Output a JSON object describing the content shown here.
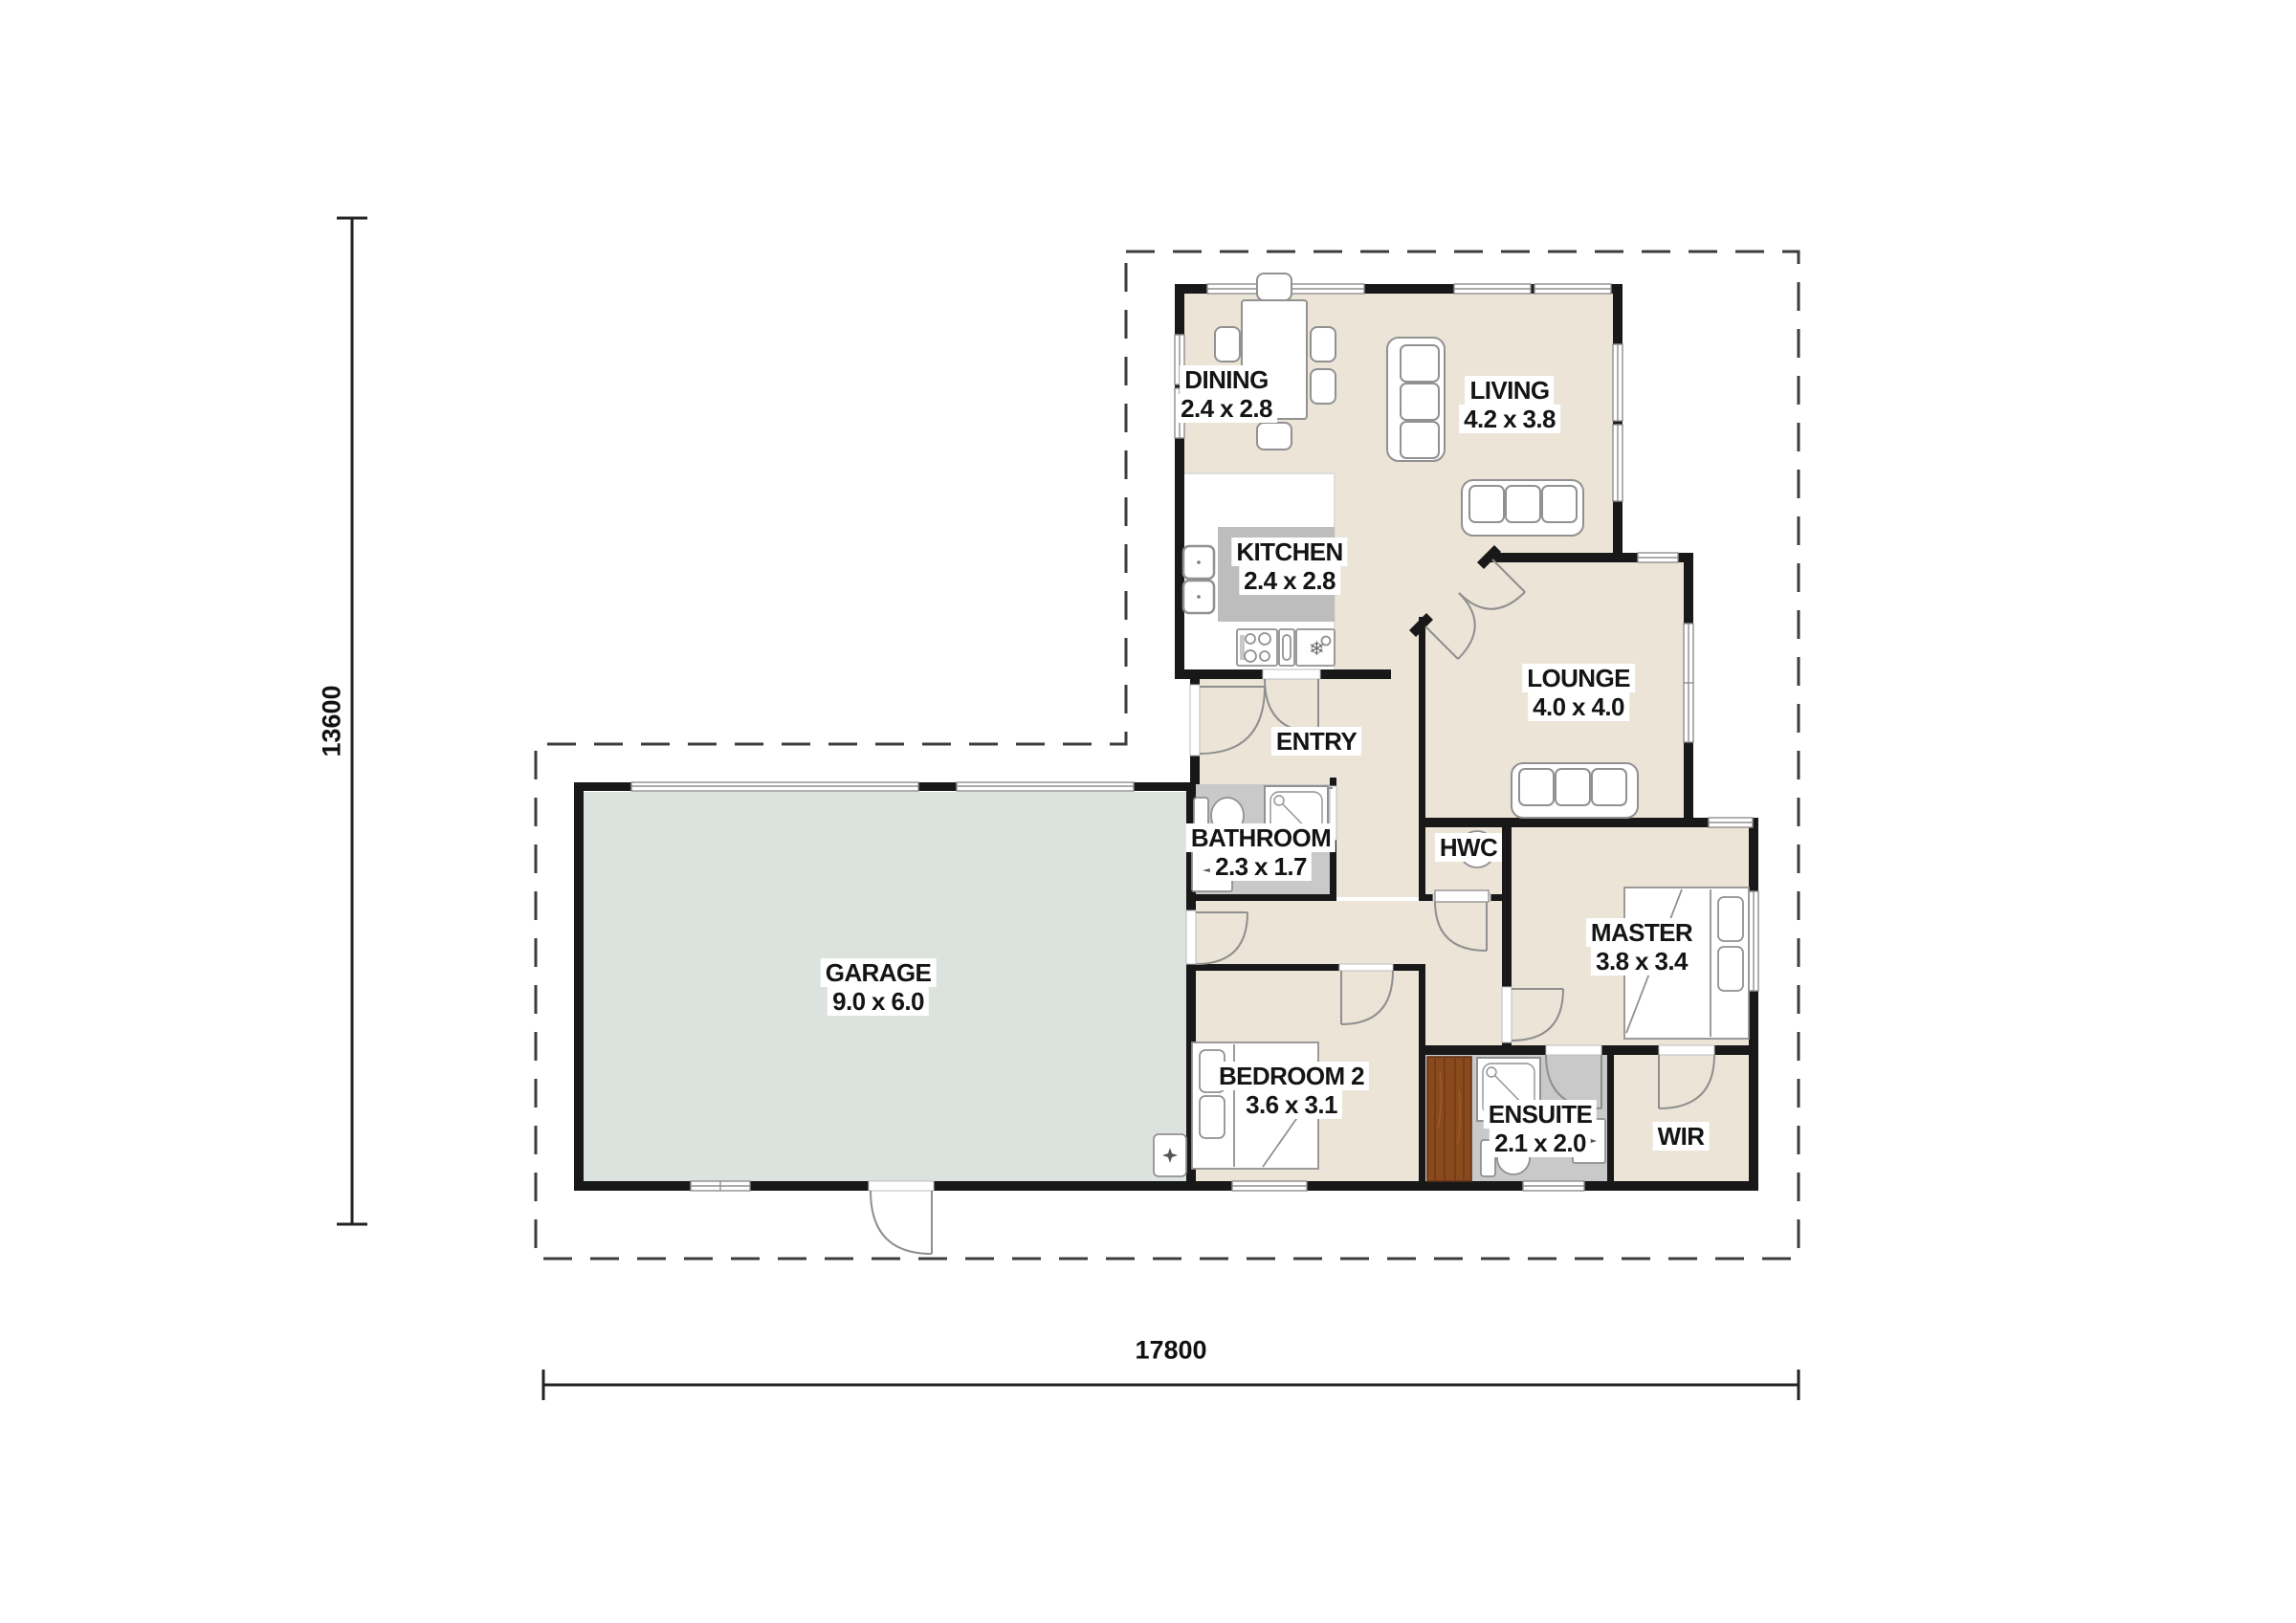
{
  "plan": {
    "type": "residential-floor-plan",
    "dimensions": {
      "width_label": "17800",
      "height_label": "13600"
    },
    "rooms": [
      {
        "id": "dining",
        "name": "DINING",
        "size": "2.4 x 2.8"
      },
      {
        "id": "living",
        "name": "LIVING",
        "size": "4.2 x 3.8"
      },
      {
        "id": "kitchen",
        "name": "KITCHEN",
        "size": "2.4 x 2.8"
      },
      {
        "id": "lounge",
        "name": "LOUNGE",
        "size": "4.0 x 4.0"
      },
      {
        "id": "entry",
        "name": "ENTRY",
        "size": ""
      },
      {
        "id": "bathroom",
        "name": "BATHROOM",
        "size": "2.3 x 1.7"
      },
      {
        "id": "hwc",
        "name": "HWC",
        "size": ""
      },
      {
        "id": "master",
        "name": "MASTER",
        "size": "3.8 x 3.4"
      },
      {
        "id": "garage",
        "name": "GARAGE",
        "size": "9.0 x 6.0"
      },
      {
        "id": "bedroom2",
        "name": "BEDROOM 2",
        "size": "3.6 x 3.1"
      },
      {
        "id": "ensuite",
        "name": "ENSUITE",
        "size": "2.1 x 2.0"
      },
      {
        "id": "wir",
        "name": "WIR",
        "size": ""
      }
    ],
    "colors": {
      "wall": "#181818",
      "floor_beige": "#ece4d6",
      "floor_wet": "#c9c9c9",
      "floor_garage": "#dce3df",
      "kitchen_island": "#bdbdbd",
      "wood_panel": "#8a4a1e",
      "fixture_stroke": "#919191",
      "boundary_dash": "#3c3c3c"
    }
  }
}
